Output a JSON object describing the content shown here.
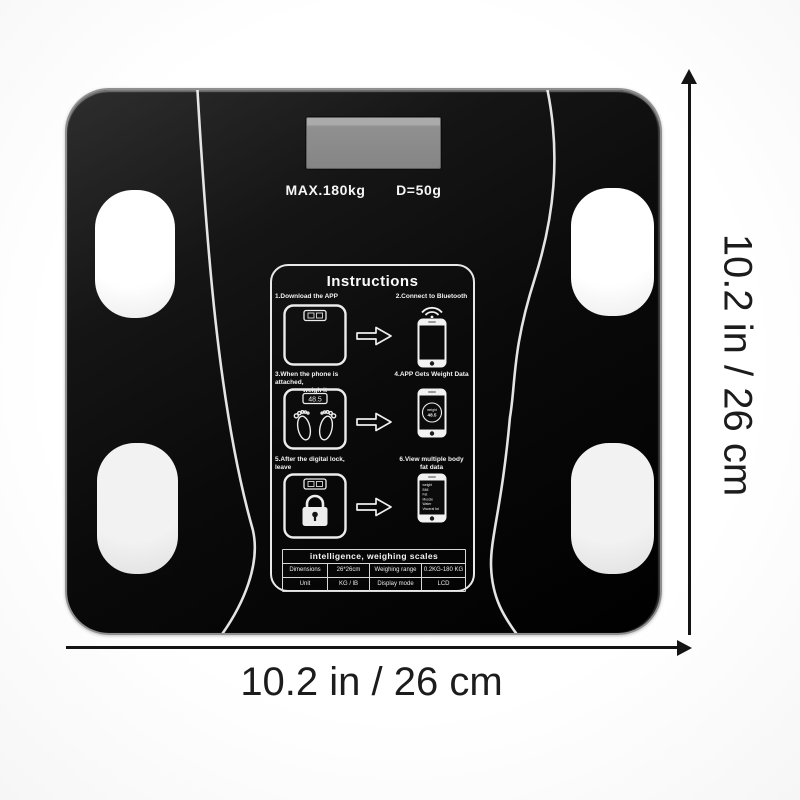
{
  "product": {
    "display_max": "MAX.180kg",
    "display_division": "D=50g"
  },
  "panel": {
    "title": "Instructions",
    "steps": [
      {
        "label": "1.Download the APP"
      },
      {
        "label": "2.Connect to Bluetooth"
      },
      {
        "label": "3.When the phone is attached,",
        "label2": "weigh it"
      },
      {
        "label": "4.APP Gets Weight Data"
      },
      {
        "label": "5.After the digital lock, leave"
      },
      {
        "label": "6.View multiple body",
        "label2": "fat data"
      }
    ],
    "scale_display_value": "48.5",
    "phone_badge": {
      "title": "weight",
      "value": "48.5"
    },
    "phone_data_lines": [
      "weight",
      "BMI",
      "Fat",
      "Muscle",
      "Water",
      "Visceral fat"
    ],
    "table": {
      "header": "intelligence, weighing scales",
      "rows": [
        [
          "Dimensions",
          "26*26cm",
          "Weighing range",
          "0.2KG-180 KG"
        ],
        [
          "Unit",
          "KG / lB",
          "Display mode",
          "LCD"
        ]
      ]
    }
  },
  "dimensions": {
    "width_label": "10.2 in / 26 cm",
    "height_label": "10.2 in / 26 cm"
  },
  "colors": {
    "scale_black": "#0a0a0a",
    "glass_line_white": "#f0f0f0",
    "lcd_gray": "#8f8f8f",
    "annotation_black": "#141414"
  }
}
